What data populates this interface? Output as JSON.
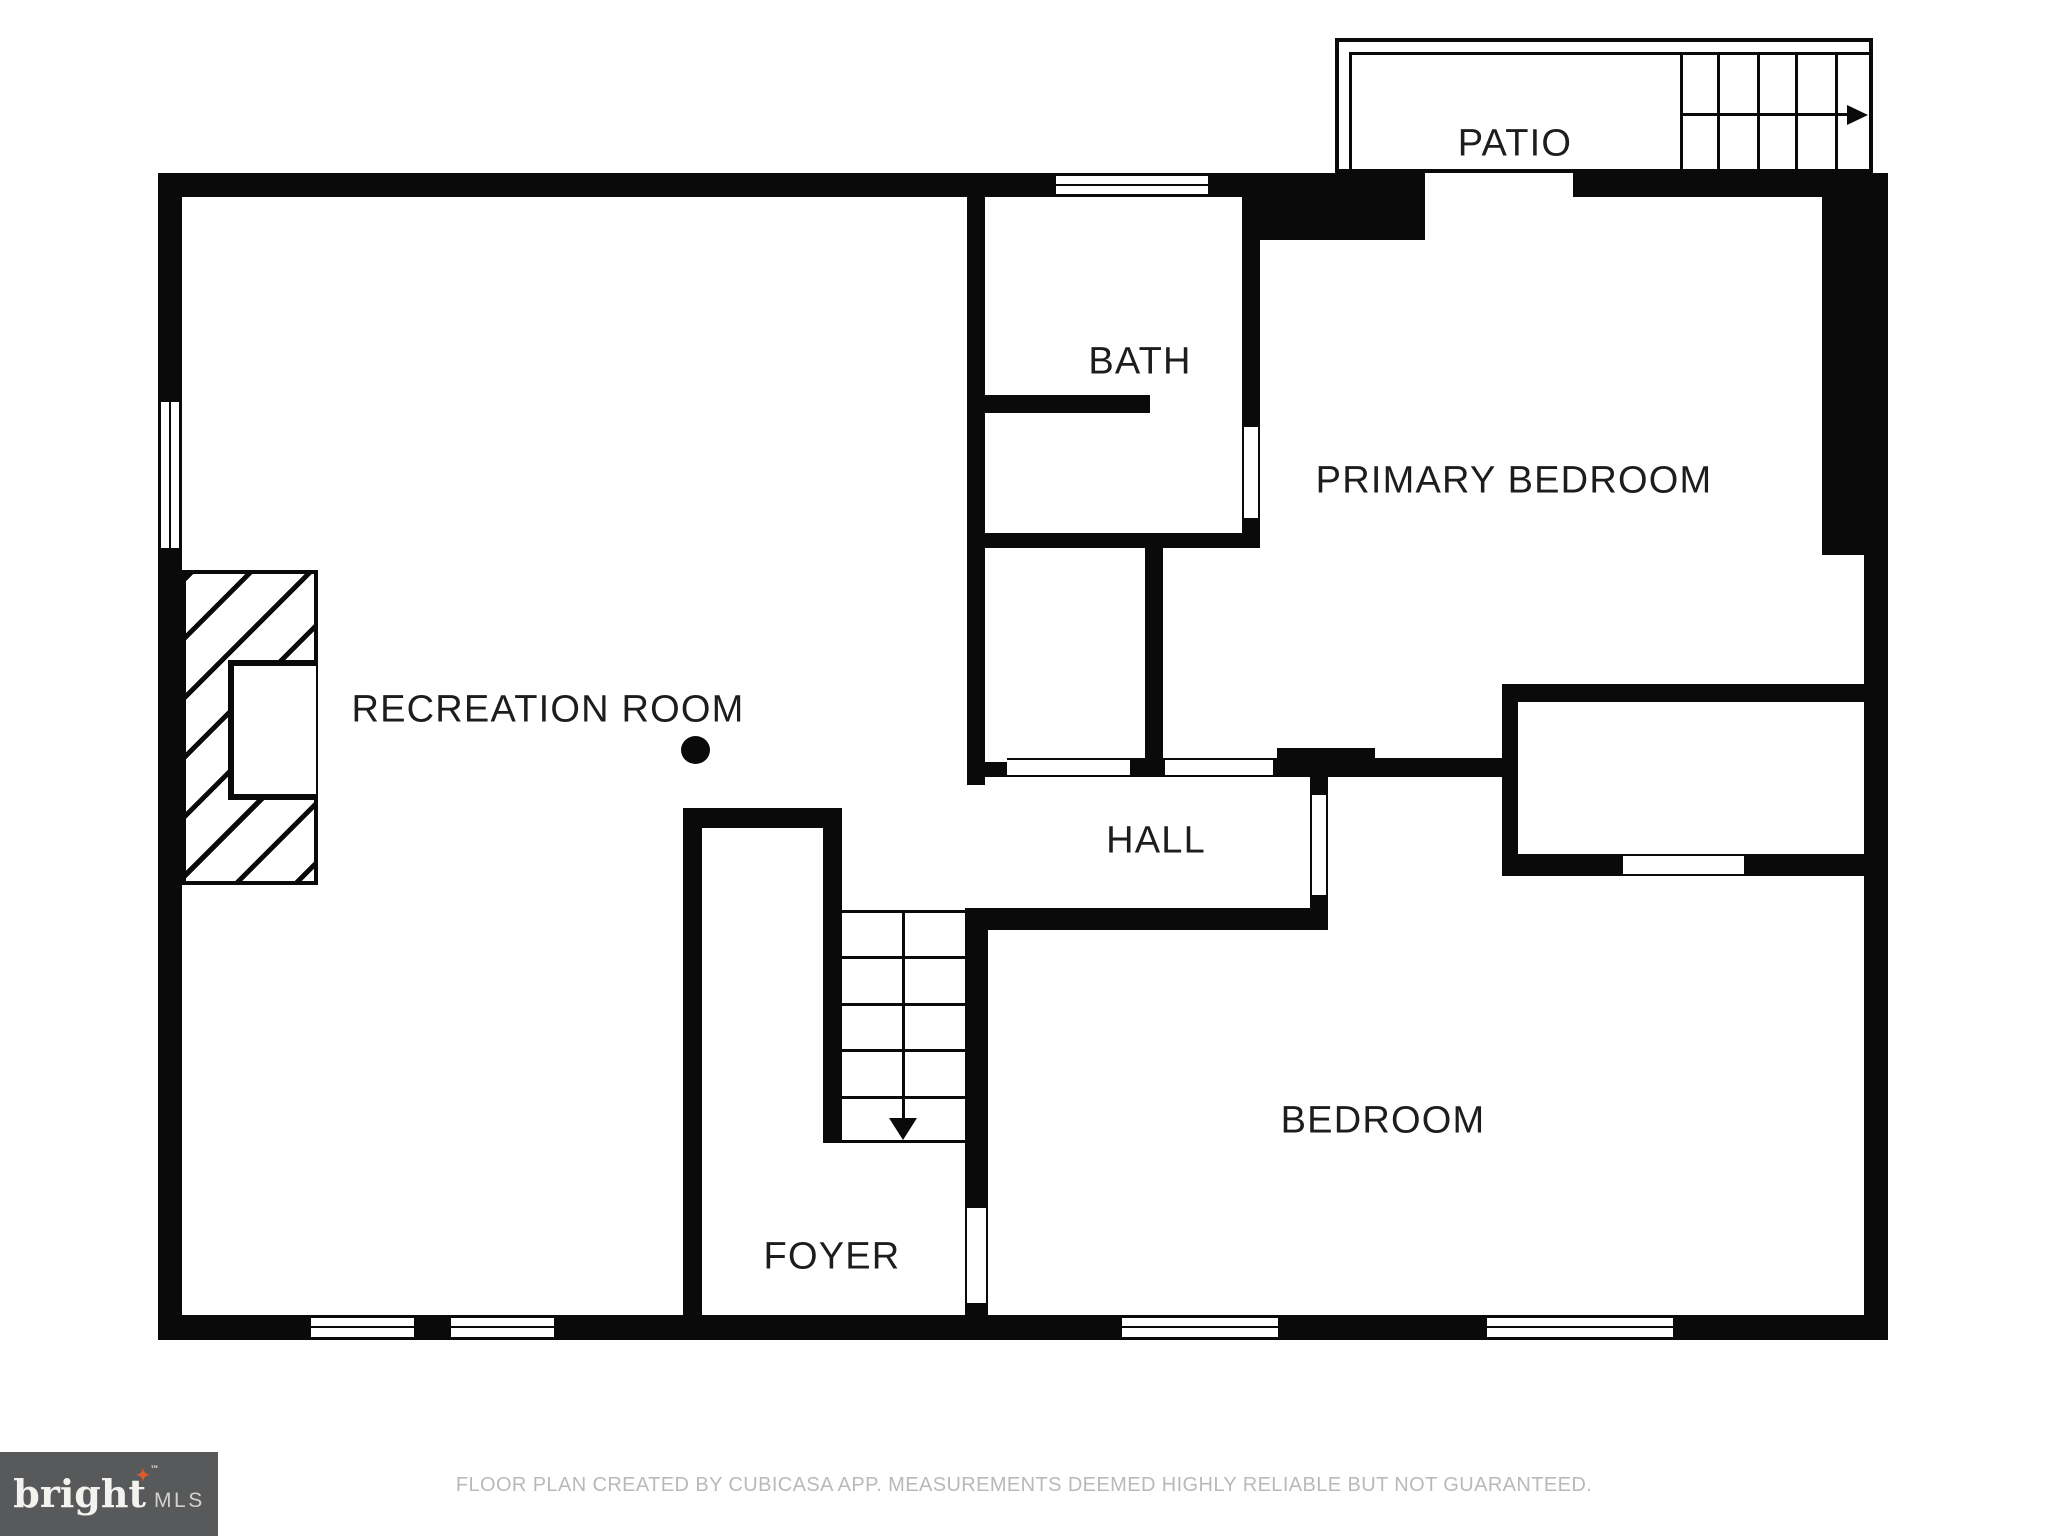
{
  "labels": {
    "patio": "PATIO",
    "bath": "BATH",
    "primary_bedroom": "PRIMARY BEDROOM",
    "recreation_room": "RECREATION ROOM",
    "hall": "HALL",
    "bedroom": "BEDROOM",
    "foyer": "FOYER"
  },
  "footer": {
    "disclaimer": "FLOOR PLAN CREATED BY CUBICASA APP. MEASUREMENTS DEEMED HIGHLY RELIABLE BUT NOT GUARANTEED."
  },
  "logo": {
    "brand": "bright",
    "star": "✦",
    "trademark": "™",
    "suffix": "MLS"
  },
  "colors": {
    "wall": "#0a0a0a",
    "label_text": "#1d1d1d",
    "footer_text": "#b9b9b9",
    "logo_background": "#58595b",
    "logo_star": "#dd5b2a"
  }
}
